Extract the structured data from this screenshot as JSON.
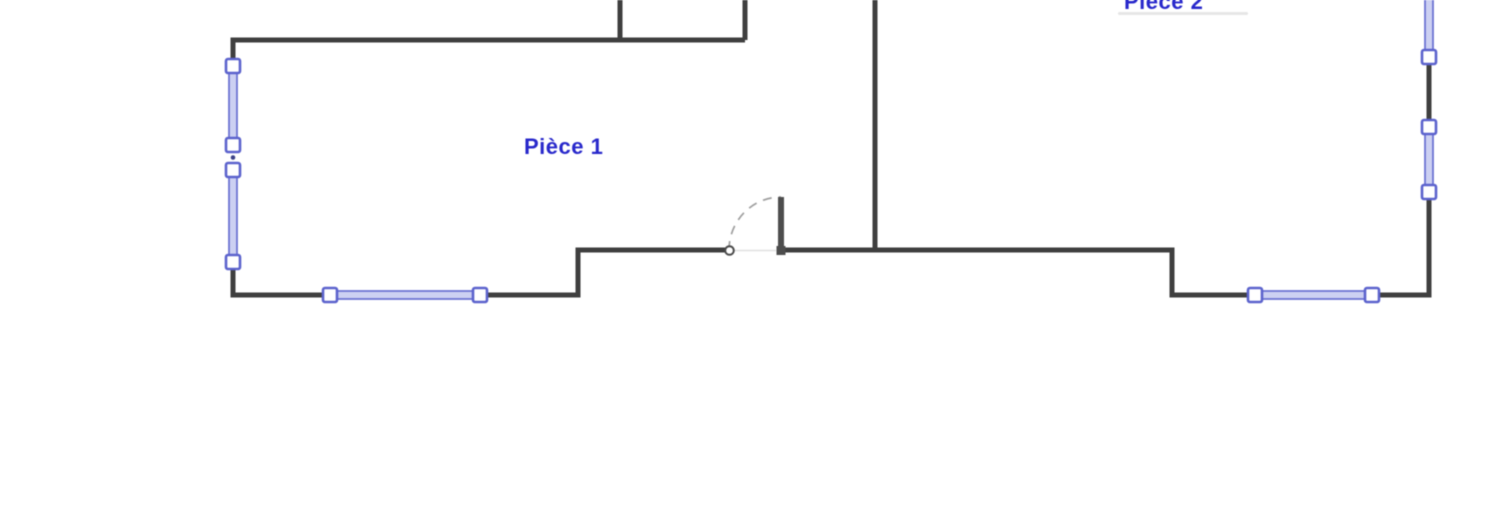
{
  "rooms": [
    {
      "name": "Pièce 1"
    },
    {
      "name": "Pièce 2"
    }
  ],
  "colors": {
    "background": "#ffffff",
    "wall": "#3f3f3f",
    "window_stroke": "#676dd1",
    "window_fill": "#ccd0f2",
    "handle_fill": "#ffffff",
    "handle_stroke": "#5c63cd",
    "label": "#2828cb",
    "door_arc": "#9e9e9e",
    "threshold": "#e0e0e0"
  }
}
